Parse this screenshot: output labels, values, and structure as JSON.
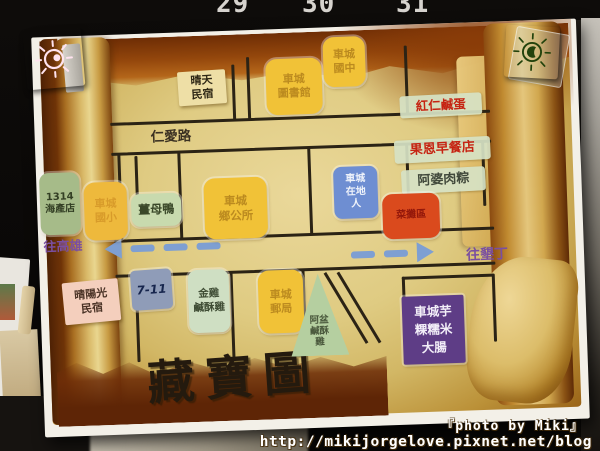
{
  "scene": {
    "ruler_numbers": [
      "29",
      "30",
      "31"
    ],
    "watermark": {
      "line1": "『photo by Miki』",
      "line2": "http://mikijorgelove.pixnet.net/blog"
    }
  },
  "magnets": {
    "left": {
      "icon": "sun-doodle",
      "color": "#e23a80",
      "stroke": "#ffe3ef"
    },
    "right": {
      "icon": "sun-doodle",
      "color": "#74cf3e",
      "stroke": "#23430c"
    }
  },
  "map": {
    "title": "藏寶圖",
    "street": "仁愛路",
    "direction_left": "往高雄",
    "direction_right": "往墾丁",
    "arrow_color": "#7e9fd2",
    "road_color": "#2b2315",
    "palette": {
      "yellow": {
        "bg": "#f1c237",
        "text": "#bb8a1f"
      },
      "yelloworange": {
        "bg": "#eeb93c",
        "text": "#d89b2a"
      },
      "tanlabel": {
        "bg": "#eedfa6",
        "text": "#2e2715"
      },
      "pinklabel": {
        "bg": "#f4cfbd",
        "text": "#4a3326"
      },
      "stripred": {
        "bg": "rgba(214,226,196,0.92)",
        "text": "#c62312"
      },
      "stripdark": {
        "bg": "rgba(214,226,196,0.92)",
        "text": "#41493b"
      },
      "red": {
        "bg": "#da4a1d",
        "text": "#93170a"
      },
      "blue": {
        "bg": "#6e8ed2",
        "text": "#eef2fa"
      },
      "sage": {
        "bg": "#a6bb89",
        "text": "#333f24"
      },
      "sagelight": {
        "bg": "#c8daae",
        "text": "#3a4829"
      },
      "sagelight2": {
        "bg": "#cfdfc3",
        "text": "#3f4d35"
      },
      "grayblue": {
        "bg": "#8f9cb8",
        "text": "#16254d"
      },
      "purple": {
        "bg": "#5e3d86",
        "text": "#f2eef8"
      },
      "triangle": {
        "bg": "#b5cfa0",
        "text": "#4a583c"
      }
    },
    "locations": [
      {
        "id": "qingtian-minsu",
        "label": "晴天\n民宿",
        "kind": "tanlabel",
        "x": 145,
        "y": 39,
        "w": 48,
        "h": 34,
        "fs": 11
      },
      {
        "id": "checheng-library",
        "label": "車城\n圖書館",
        "kind": "yellow",
        "x": 233,
        "y": 30,
        "w": 56,
        "h": 56,
        "fs": 11
      },
      {
        "id": "checheng-junior-high",
        "label": "車城\n國中",
        "kind": "yellow",
        "x": 291,
        "y": 10,
        "w": 42,
        "h": 50,
        "fs": 11
      },
      {
        "id": "red-salted-egg",
        "label": "紅仁鹹蛋",
        "kind": "stripred",
        "x": 366,
        "y": 71,
        "w": 82,
        "h": 22,
        "fs": 12.5
      },
      {
        "id": "guoen-breakfast",
        "label": "果恩早餐店",
        "kind": "stripred",
        "x": 359,
        "y": 115,
        "w": 96,
        "h": 23,
        "fs": 13
      },
      {
        "id": "apo-rice-dumpling",
        "label": "阿婆肉粽",
        "kind": "stripdark",
        "x": 365,
        "y": 145,
        "w": 84,
        "h": 24,
        "fs": 13
      },
      {
        "id": "market-stall-area",
        "label": "菜攤區",
        "kind": "red",
        "x": 345,
        "y": 169,
        "w": 57,
        "h": 45,
        "fs": 10
      },
      {
        "id": "checheng-local",
        "label": "車城\n在地\n人",
        "kind": "blue",
        "x": 297,
        "y": 140,
        "w": 44,
        "h": 52,
        "fs": 10
      },
      {
        "id": "seafood-1314",
        "label": "1314\n海產店",
        "kind": "sage",
        "x": 3,
        "y": 136,
        "w": 40,
        "h": 62,
        "fs": 10
      },
      {
        "id": "checheng-elementary",
        "label": "車城\n國小",
        "kind": "yelloworange",
        "x": 47,
        "y": 147,
        "w": 43,
        "h": 58,
        "fs": 11
      },
      {
        "id": "ginger-duck",
        "label": "薑母鴨",
        "kind": "sagelight",
        "x": 94,
        "y": 160,
        "w": 50,
        "h": 33,
        "fs": 12
      },
      {
        "id": "township-office",
        "label": "車城\n鄉公所",
        "kind": "yellow",
        "x": 167,
        "y": 147,
        "w": 63,
        "h": 61,
        "fs": 11.5
      },
      {
        "id": "seven-eleven",
        "label": "7-11",
        "kind": "grayblue",
        "x": 91,
        "y": 236,
        "w": 41,
        "h": 40,
        "fs": 12
      },
      {
        "id": "sunshine-minsu",
        "label": "晴陽光\n民宿",
        "kind": "pinklabel",
        "x": 23,
        "y": 245,
        "w": 56,
        "h": 42,
        "fs": 11
      },
      {
        "id": "golden-chicken",
        "label": "金雞\n鹹酥雞",
        "kind": "sagelight2",
        "x": 148,
        "y": 238,
        "w": 41,
        "h": 63,
        "fs": 10.5
      },
      {
        "id": "post-office",
        "label": "車城\n郵局",
        "kind": "yellow",
        "x": 218,
        "y": 241,
        "w": 45,
        "h": 63,
        "fs": 11
      },
      {
        "id": "apen-chicken",
        "label": "阿盆\n鹹酥\n雞",
        "kind": "triangle",
        "x": 249,
        "y": 246,
        "w": 58,
        "h": 82,
        "fs": 9.5
      },
      {
        "id": "taro-rice-sausage",
        "label": "車城芋\n粿糯米\n大腸",
        "kind": "purple",
        "x": 361,
        "y": 272,
        "w": 62,
        "h": 68,
        "fs": 12.5
      }
    ],
    "roads": [
      {
        "x": 76,
        "y": 88,
        "w": 380,
        "h": 2.5
      },
      {
        "x": 76,
        "y": 118,
        "w": 380,
        "h": 2.5
      },
      {
        "x": 76,
        "y": 205,
        "w": 380,
        "h": 2.5
      },
      {
        "x": 76,
        "y": 240,
        "w": 380,
        "h": 2.5
      },
      {
        "x": 199,
        "y": 34,
        "w": 2.5,
        "h": 56
      },
      {
        "x": 214,
        "y": 27,
        "w": 2.5,
        "h": 63
      },
      {
        "x": 372,
        "y": 21,
        "w": 2.5,
        "h": 69
      },
      {
        "x": 82,
        "y": 120,
        "w": 2.5,
        "h": 87
      },
      {
        "x": 142,
        "y": 120,
        "w": 2.5,
        "h": 87
      },
      {
        "x": 272,
        "y": 120,
        "w": 2.5,
        "h": 87
      },
      {
        "x": 370,
        "y": 120,
        "w": 2.5,
        "h": 87
      },
      {
        "x": 446,
        "y": 120,
        "w": 2.5,
        "h": 64
      },
      {
        "x": 99,
        "y": 122,
        "w": 2.5,
        "h": 46
      },
      {
        "x": 99,
        "y": 166,
        "w": 45,
        "h": 2.5
      },
      {
        "x": 95,
        "y": 242,
        "w": 2.5,
        "h": 86
      },
      {
        "x": 190,
        "y": 242,
        "w": 2.5,
        "h": 86
      },
      {
        "x": 262,
        "y": 242,
        "w": 2.5,
        "h": 80
      },
      {
        "x": 362,
        "y": 252,
        "w": 2.5,
        "h": 74
      },
      {
        "x": 452,
        "y": 252,
        "w": 2.5,
        "h": 68
      },
      {
        "x": 362,
        "y": 252,
        "w": 92,
        "h": 2.5
      }
    ],
    "diagonal_roads": [
      {
        "x": 284,
        "y": 246,
        "len": 82,
        "rot": -29
      },
      {
        "x": 297,
        "y": 246,
        "len": 82,
        "rot": -29
      }
    ],
    "arrows": {
      "left_dashes": 3,
      "right_dashes": 2
    }
  }
}
